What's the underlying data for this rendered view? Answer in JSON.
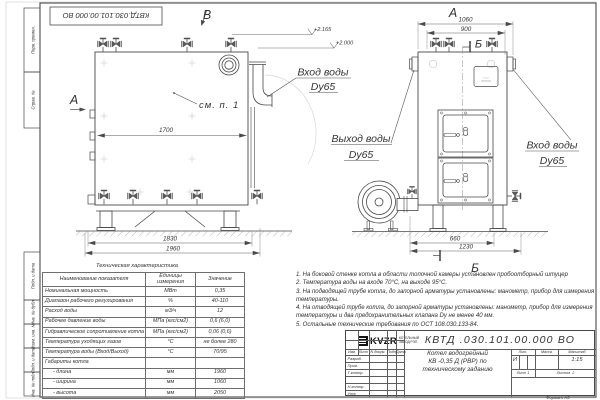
{
  "sheet": {
    "stamp_designation": "КВТД.030.101.00.000  ВО",
    "format_label": "Формат    А3"
  },
  "margin": {
    "labels": [
      "Перв. примен.",
      "Справ. №",
      "Подп. и дата",
      "Инв. № дубл.",
      "Взам. инв. №",
      "Подп. и дата",
      "Инв. № подл."
    ]
  },
  "drawing": {
    "view_a": "А",
    "view_b": "В",
    "section_b": "Б",
    "see_note": "см. п. 1",
    "elevation_1": "+2.165",
    "elevation_2": "+2.000",
    "water_inlet": {
      "line1": "Вход воды",
      "line2": "Dy65"
    },
    "water_outlet": {
      "line1": "Выход воды",
      "line2": "Dy65"
    },
    "dims": {
      "front_inner": "1700",
      "front_support": "1830",
      "front_length": "1960",
      "side_overall": "1060",
      "side_top": "900",
      "side_base": "660",
      "side_depth": "1230"
    }
  },
  "spec_table": {
    "title": "Техническая характеристика",
    "col_name": "Наименование показателя",
    "col_units": "Единицы измерения",
    "col_value": "Значение",
    "rows": [
      {
        "name": "Номинальная мощность",
        "units": "МВт",
        "value": "0,35"
      },
      {
        "name": "Диапазон рабочего регулирования",
        "units": "%",
        "value": "40-110"
      },
      {
        "name": "Расход воды",
        "units": "м3/ч",
        "value": "12"
      },
      {
        "name": "Рабочее давление воды",
        "units": "МПа (кгс/см2)",
        "value": "0,6 (6,0)"
      },
      {
        "name": "Гидравлическое сопротивление котла",
        "units": "МПа (кгс/см2)",
        "value": "0,06 (0,6)"
      },
      {
        "name": "Температура уходящих газов",
        "units": "°С",
        "value": "не более 280"
      },
      {
        "name": "Температура воды (Вход/Выход)",
        "units": "°С",
        "value": "70/95"
      },
      {
        "name": "Габариты котла",
        "units": "",
        "value": ""
      },
      {
        "name": "- длина",
        "units": "мм",
        "value": "1960"
      },
      {
        "name": "- ширина",
        "units": "мм",
        "value": "1060"
      },
      {
        "name": "- высота",
        "units": "мм",
        "value": "2050"
      }
    ]
  },
  "notes": {
    "items": [
      "1.  На боковой стенке котла в области топочной камеры установлен пробоотборный штуцер",
      "2.  Температура воды на входе  70°С,  на выходе  95°С.",
      "3.  На подводящей трубе котла, до запорной арматуры установлены: манометр, прибор для измерения температуры.",
      "4.  На отводящей трубе котла, до запорной арматуры установлены: манометр, прибор для измерения температуры и два предохранительных клапана  Dу не менее  40 мм.",
      "5.  Остальные технические требования по ОСТ  108.030.133-84."
    ]
  },
  "title_block": {
    "designation": "КВТД .030.101.00.000  ВО",
    "doc_name_line1": "Котел водогрейный",
    "doc_name_line2": "КВ -0,35  Д  (РВР) по",
    "doc_name_line3": "техническому заданию",
    "cols": {
      "izm": "Изм.",
      "list": "Лист",
      "doc": "N докум.",
      "podp": "Подп.",
      "data": "Дата"
    },
    "rows": {
      "razrab": "Разраб.",
      "prov": "Пров.",
      "tkontr": "Т.контр.",
      "nkontr": "Н.контр.",
      "utv": "Утв."
    },
    "lit_label": "Лит.",
    "mass_label": "Масса",
    "scale_label": "Масштаб",
    "lit_value": "И",
    "scale_value": "1:15",
    "sheet_label": "Лист",
    "sheet_value": "1",
    "sheets_label": "Листов",
    "sheets_value": "2",
    "company": {
      "logo": "KVZR",
      "name_line1": "КОТЕЛЬНЫЙ",
      "name_line2": "ЗАВОД РЭП"
    }
  }
}
